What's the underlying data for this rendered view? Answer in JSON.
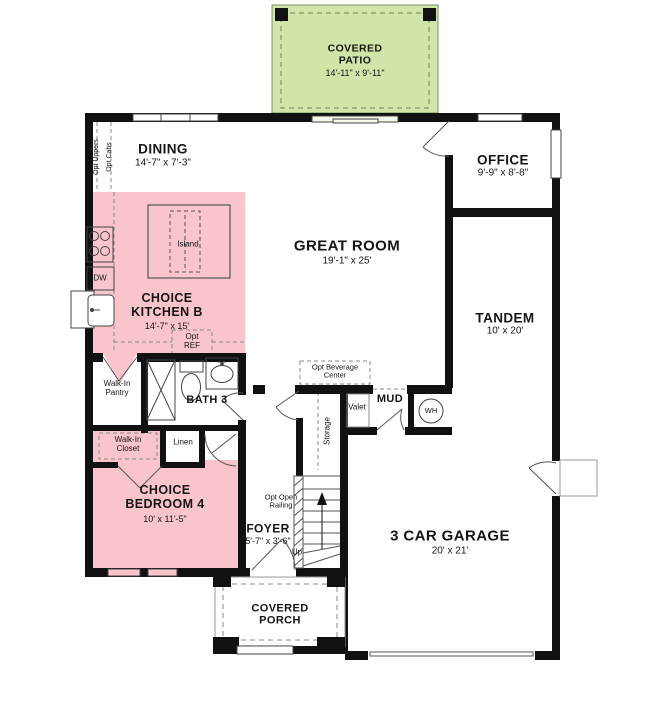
{
  "title": "Floor plan",
  "colors": {
    "patio_green": "#cfe6a8",
    "option_pink": "#f9c4cb",
    "wall": "#111111"
  },
  "rooms": {
    "covered_patio": {
      "name": "COVERED PATIO",
      "dims": "14'-11\" x 9'-11\""
    },
    "dining": {
      "name": "DINING",
      "dims": "14'-7\" x 7'-3\""
    },
    "office": {
      "name": "OFFICE",
      "dims": "9'-9\" x 8'-8\""
    },
    "great_room": {
      "name": "GREAT ROOM",
      "dims": "19'-1\" x 25'"
    },
    "kitchen": {
      "name": "CHOICE KITCHEN B",
      "dims": "14'-7\" x 15'"
    },
    "tandem": {
      "name": "TANDEM",
      "dims": "10' x 20'"
    },
    "bath3": {
      "name": "BATH 3"
    },
    "pantry": {
      "name": "Walk-In Pantry"
    },
    "mud": {
      "name": "MUD"
    },
    "valet": {
      "name": "Valet"
    },
    "storage": {
      "name": "Storage"
    },
    "water_heater": {
      "name": "WH"
    },
    "closet": {
      "name": "Walk-In Closet"
    },
    "linen": {
      "name": "Linen"
    },
    "bedroom4": {
      "name": "CHOICE BEDROOM 4",
      "dims": "10' x 11'-5\""
    },
    "foyer": {
      "name": "FOYER",
      "dims": "5'-7\" x 3'-6\""
    },
    "garage": {
      "name": "3 CAR GARAGE",
      "dims": "20' x 21'"
    },
    "covered_porch": {
      "name": "COVERED PORCH"
    }
  },
  "annotations": {
    "opt_uppers": "Opt Uppers",
    "opt_cabs": "Opt Cabs",
    "opt_ref": "Opt REF",
    "opt_beverage_center": "Opt Beverage Center",
    "opt_open_railing": "Opt Open Railing",
    "island": "Island",
    "dishwasher": "DW",
    "up": "Up"
  }
}
